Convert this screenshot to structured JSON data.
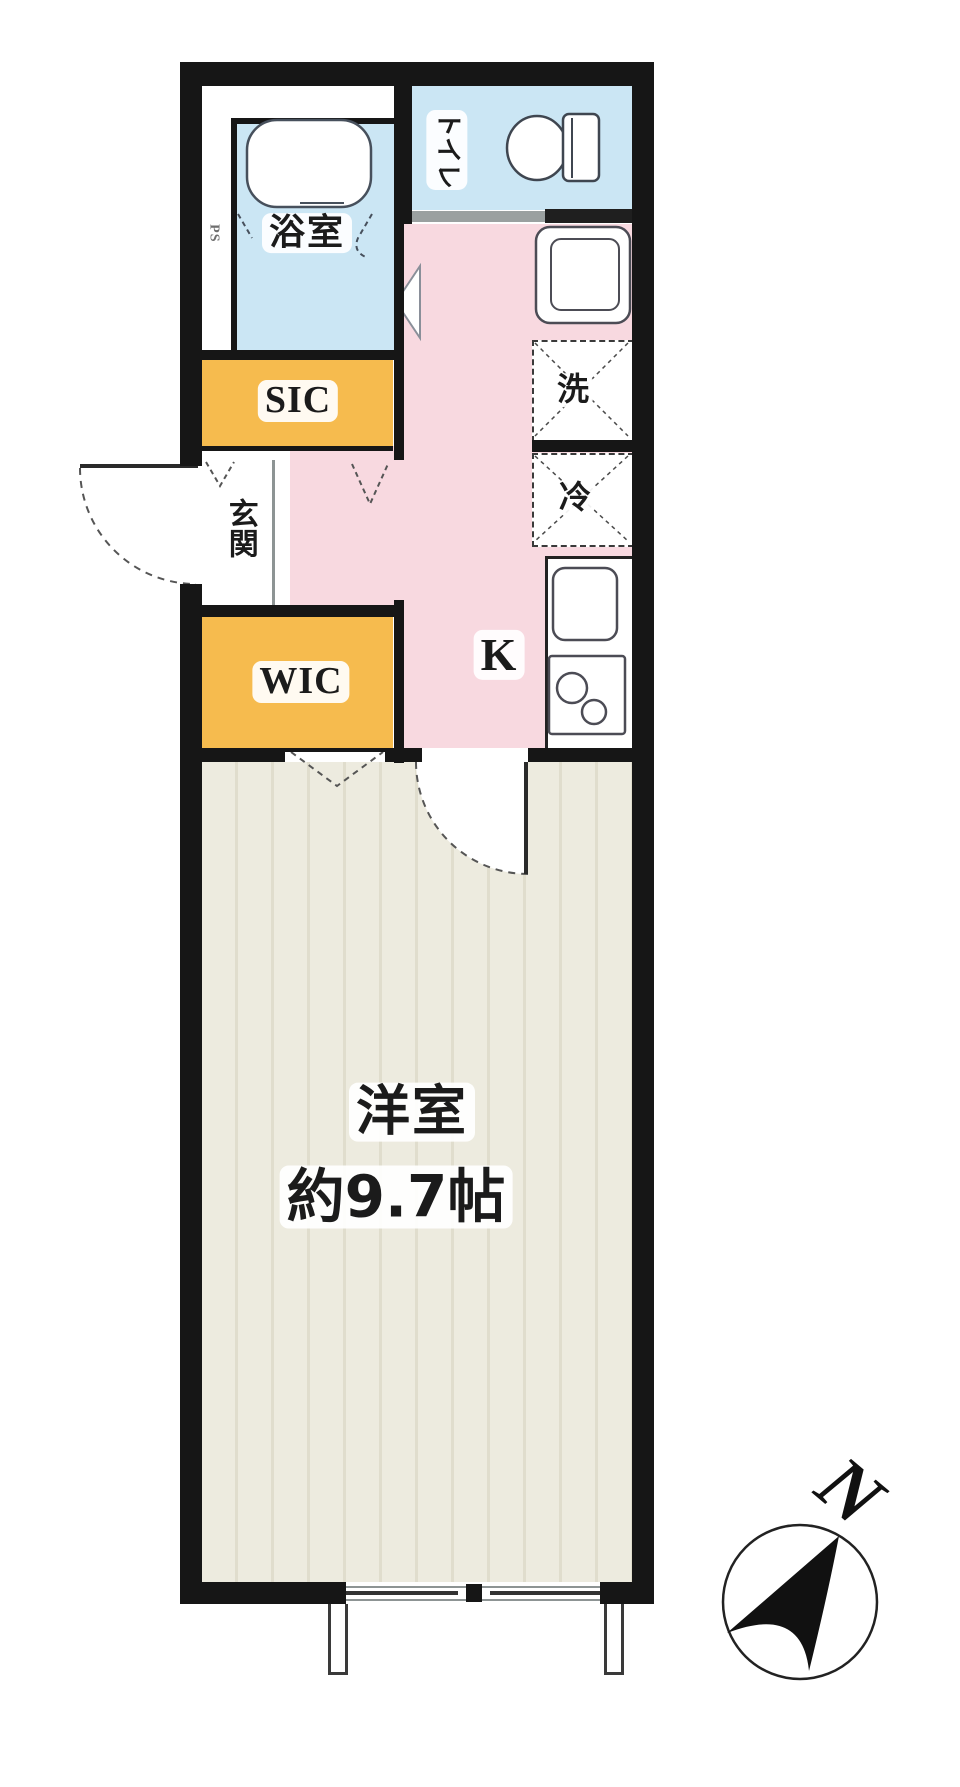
{
  "plan": {
    "labels": {
      "bathroom": "浴室",
      "toilet": "トイレ",
      "pipe_space": "PS",
      "sic": "SIC",
      "entrance": "玄関",
      "wic": "WIC",
      "kitchen": "K",
      "washer": "洗",
      "fridge": "冷",
      "western_room": "洋室",
      "western_room_size": "約9.7帖",
      "compass_north": "N"
    },
    "colors": {
      "wall": "#161616",
      "water_blue": "#cbe6f4",
      "hall_pink": "#f8d9e0",
      "closet_orange": "#f6bb4e",
      "room_beige": "#edebdf",
      "room_stripe": "#e0ddcd"
    }
  }
}
